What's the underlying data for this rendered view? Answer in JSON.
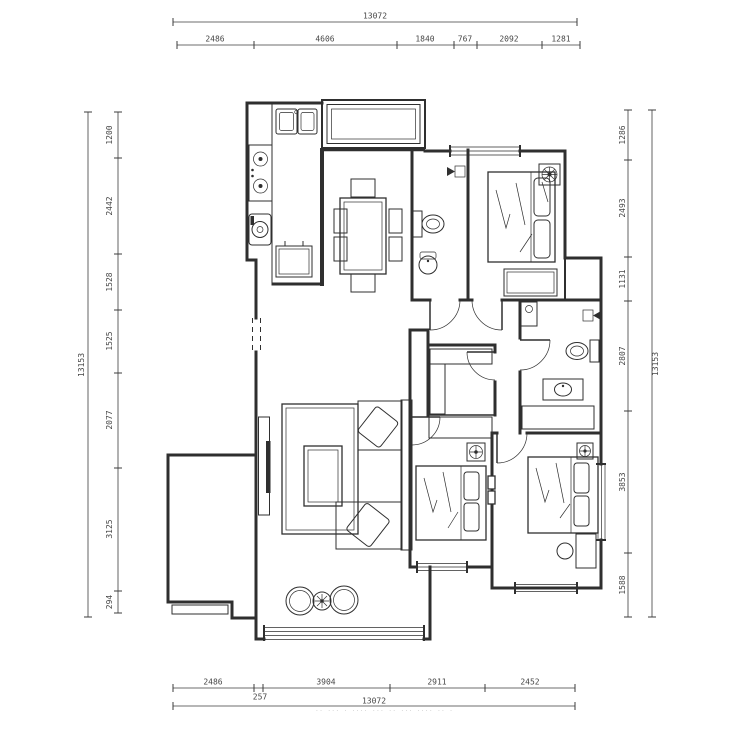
{
  "dims": {
    "top": {
      "total": "13072",
      "segments": [
        "2486",
        "4606",
        "1840",
        "767",
        "2092",
        "1281"
      ]
    },
    "bottom": {
      "total": "13072",
      "segments": [
        "2486",
        "257",
        "3904",
        "2911",
        "2452"
      ]
    },
    "left": {
      "total": "13153",
      "segments": [
        "1200",
        "2442",
        "1528",
        "1525",
        "2077",
        "3125",
        "294"
      ]
    },
    "right": {
      "total": "13153",
      "segments": [
        "1286",
        "2493",
        "1131",
        "2807",
        "3853",
        "1588"
      ]
    }
  },
  "footer_marks": "·· ··· · ···· ··· ·· ··· ···· ·· ·",
  "colors": {
    "line": "#2f2f2f",
    "dim_text": "#474747",
    "watermark": "#bdbdbd",
    "background": "#ffffff"
  }
}
